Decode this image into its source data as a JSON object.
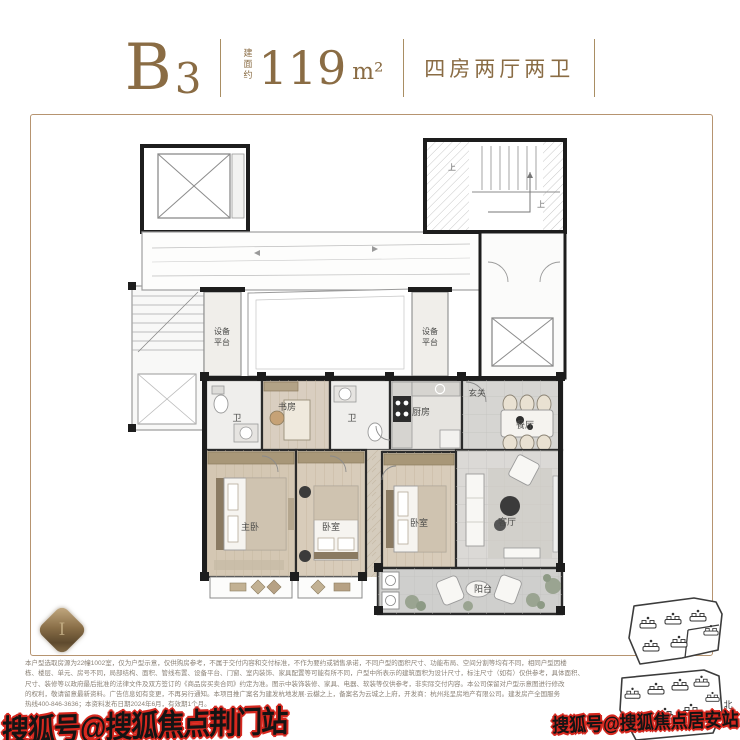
{
  "header": {
    "unit_main": "B",
    "unit_sub": "3",
    "area_prefix": "建面约",
    "area_value": "119",
    "area_unit": "m²",
    "layout_type": "四房两厅两卫",
    "accent_color": "#8a6c44"
  },
  "plan": {
    "frame_color": "#b69470",
    "labels": [
      {
        "t": "设备"
      },
      {
        "t": "平台"
      },
      {
        "t": "设备"
      },
      {
        "t": "平台"
      },
      {
        "t": "卫"
      },
      {
        "t": "书房"
      },
      {
        "t": "卫"
      },
      {
        "t": "厨房"
      },
      {
        "t": "玄关"
      },
      {
        "t": "餐厅"
      },
      {
        "t": "主卧"
      },
      {
        "t": "卧室"
      },
      {
        "t": "卧室"
      },
      {
        "t": "客厅"
      },
      {
        "t": "阳台"
      },
      {
        "t": "上"
      },
      {
        "t": "上"
      }
    ]
  },
  "logo": {
    "glyph": "I"
  },
  "disclaimer": {
    "lines": [
      "本户型选取房源为22幢1002室，仅为户型示意，仅供购房参考，不属于交付内容和交付标准，不作为要约或销售承诺，不同户型的面积尺寸、功能布局、空间分割等均有不同，相同户型因楼",
      "栋、楼层、单元、房号不同，局部结构、面积、管线布置、设备平台、门窗、室内装饰、家具配置等可能有所不同，户型中所表示的建筑面积为设计尺寸，标注尺寸（如有）仅供参考，具体面积、",
      "尺寸、装修等以政府最后批准的法律文件及双方签订的《商品房买卖合同》约定为准。图示中装饰装修、家具、电器、软装等仅供参考，非实际交付内容。本公司保留对户型示意图进行修改",
      "的权利，敬请留意最新资料。广告信息如有变更，不再另行通知。本项目推广案名为建发杭地发展·云樾之上，备案名为云城之上府，开发商：杭州兆呈房地产有限公司。建发房产全国服务",
      "热线400-846-3636；本资料发布日期2024年6月，有效期1个月。"
    ]
  },
  "sitemap": {
    "north_label": "北"
  },
  "watermarks": {
    "bottom_left": "搜狐号@搜狐焦点荆门站",
    "bottom_right": "搜狐号@搜狐焦点居安站"
  }
}
